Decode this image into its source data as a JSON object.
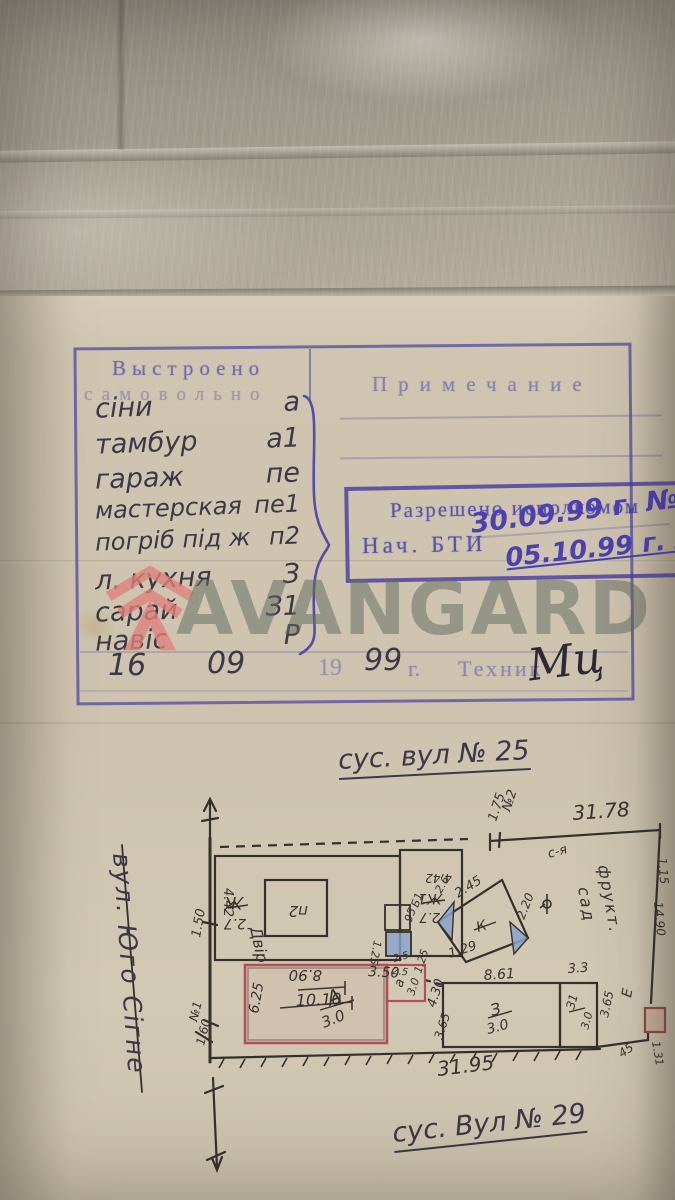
{
  "photo": {
    "paper_color": "#cdc3b0",
    "backdrop_color": "#a29c8d",
    "stamp_ink_color": "#5447ac",
    "pen_ink_color": "#4d41b0",
    "pencil_color": "#3e3748",
    "plan_red_outline": "#b24f58",
    "plan_blue_fill": "#8aa3cb"
  },
  "watermark": {
    "text": "AVANGARD",
    "logo": "avangard-shield-logo",
    "logo_color": "#e0807a"
  },
  "built_table": {
    "header_col1_line1": "Выстроено",
    "header_col1_line2": "самовольно",
    "header_col2": "Примечание",
    "rows": [
      {
        "name": "сіни",
        "code": "а"
      },
      {
        "name": "тамбур",
        "code": "а1"
      },
      {
        "name": "гараж",
        "code": "пе"
      },
      {
        "name": "мастерская",
        "code": "пе1"
      },
      {
        "name": "погріб під ж",
        "code": "п2"
      },
      {
        "name": "л. кухня",
        "code": "З"
      },
      {
        "name": "сарай",
        "code": "З1"
      },
      {
        "name": "навіс",
        "code": "Р"
      }
    ]
  },
  "permit_stamp": {
    "title": "Разрешено исполкомом",
    "signer": "Нач. БТИ",
    "date1": "30.09.99 г. №6",
    "date2": "05.10.99 г. №"
  },
  "date_line": {
    "day": "16",
    "month": "09",
    "century": "19",
    "year": "99",
    "suffix": "г.",
    "role": "Техник",
    "signature": "Мц"
  },
  "plan": {
    "street_top": "сус. вул № 25",
    "street_bottom": "сус. Вул № 29",
    "street_left": "вул. Юго Сігне",
    "labels": {
      "d3178": "31.78",
      "n2": "№2",
      "d175": "1.75",
      "sya": "с-я",
      "frukt": "фрукт.",
      "sad": "сад",
      "d115": "1.15",
      "d1490": "14.90",
      "d131": "1.31",
      "zh": "Ж",
      "zh1": "Ж1",
      "d27": "2.7",
      "d442": "4.42",
      "p2": "п2",
      "d890": "8.90",
      "d350": "3.50",
      "d125": "1.25",
      "d1010": "10.10",
      "dvir": "Двір",
      "d150": "1.50",
      "n1": "№1",
      "d160": "1.60",
      "k": "К",
      "d245": "2.45",
      "d220": "2.20",
      "d129": "1.29",
      "d26": "2.6",
      "b1": "Б1",
      "d095": ".95",
      "d25": "2.5",
      "a_big": "А",
      "d30": "3.0",
      "d625": "6.25",
      "a_small": "а",
      "d430": "4.30",
      "d365": "3.65",
      "z": "З",
      "z1": "З1",
      "d861": "8.61",
      "d33": "3.3",
      "e": "Е",
      "d45": "45",
      "d3195": "31.95"
    }
  }
}
